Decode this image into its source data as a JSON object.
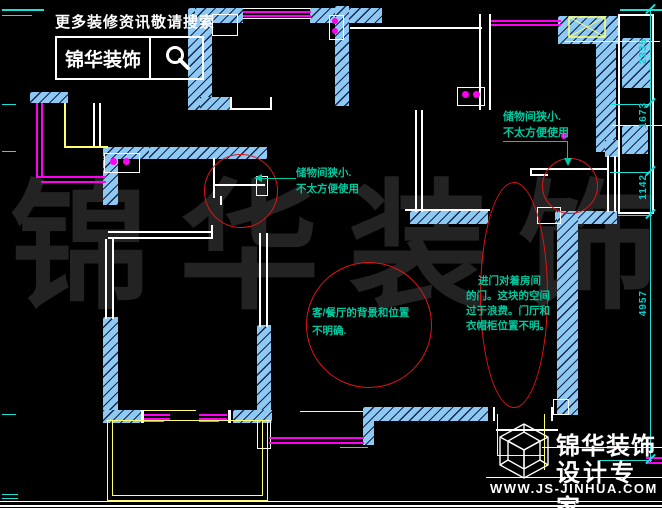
{
  "branding_top": {
    "tagline": "更多装修资讯敬请搜索",
    "logo_text": "锦华装饰"
  },
  "watermark": {
    "char1": "锦",
    "char2": "华",
    "char3": "装",
    "char4": "饰"
  },
  "annotations": {
    "storage_left": {
      "line1": "储物间狭小.",
      "line2": "不太方便使用"
    },
    "storage_right": {
      "line1": "储物间狭小.",
      "line2": "不太方便使用"
    },
    "living": {
      "line1": "客/餐厅的背景和位置",
      "line2": "不明确."
    },
    "entry": {
      "line1": "进门对着房间",
      "line2": "的门。这块的空间",
      "line3": "过于浪费。门厅和",
      "line4": "衣帽柜位置不明。"
    }
  },
  "dimensions": {
    "right": [
      "2335",
      "1673",
      "1142",
      "4957"
    ]
  },
  "logo_bottom": {
    "name_line1": "锦华装饰",
    "name_line2": "设计专家",
    "url": "WWW.JS-JINHUA.COM"
  },
  "colors": {
    "wall_blue": "#8ec9f4",
    "annotation_green": "#00c9a0",
    "marker_red": "#e31414",
    "window_magenta": "#ff00f0",
    "furniture_yellow": "#ffff70",
    "dimension_cyan": "#1ae0dc",
    "watermark_gray": "#232323"
  }
}
